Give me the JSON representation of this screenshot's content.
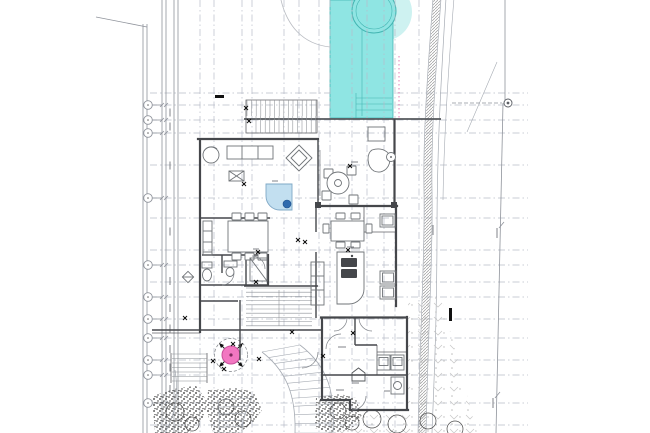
{
  "meta": {
    "canvas_width": 650,
    "canvas_height": 433,
    "drawing_kind": "architectural site and floor plan, no legible text labels"
  },
  "colors": {
    "background": "#ffffff",
    "grid_line": "#b7bcc8",
    "boundary_line": "#8f939b",
    "wall": "#45474b",
    "furniture_line": "#6f7377",
    "pool_fill": "#8fe5e3",
    "pool_edge": "#43b5b2",
    "pool_halo": "#cef2f1",
    "water_feature_fill": "#c2dff0",
    "water_feature_dot": "#2f6bae",
    "tree_pink": "#f277c1",
    "tree_pink_dark": "#c94f9b",
    "setback_pink": "#e06fae",
    "stipple": "#2e2e2e",
    "hatch": "#9a9a9a",
    "paver": "#c2c2c2",
    "marker_black": "#111111",
    "micro_text": "#777b80"
  },
  "drawing": {
    "grid": {
      "vertical_x": [
        200,
        214,
        242,
        252,
        284,
        299,
        319,
        330,
        352,
        367,
        384,
        395,
        419
      ],
      "horizontal_y": [
        93,
        105,
        120,
        133,
        165,
        198,
        218,
        250,
        265,
        282,
        297,
        319,
        338,
        360,
        375,
        403,
        425
      ],
      "h_x1": 150,
      "h_x2": 528
    },
    "boundary": {
      "lines": [
        {
          "x": 143,
          "y1": 24,
          "y2": 433
        },
        {
          "x": 147,
          "y1": 24,
          "y2": 433
        },
        {
          "x": 162,
          "y1": 0,
          "y2": 433
        },
        {
          "x": 166,
          "y1": 0,
          "y2": 433
        },
        {
          "x": 174,
          "y1": 0,
          "y2": 433
        },
        {
          "x": 178,
          "y1": 0,
          "y2": 433
        }
      ],
      "diagonal": {
        "x1": 96,
        "y1": 17,
        "x2": 147,
        "y2": 27
      },
      "bubbles_x": 148,
      "bubbles_y": [
        105,
        120,
        133,
        198,
        265,
        297,
        319,
        338,
        360,
        375,
        403
      ],
      "dim_text_x": 170
    },
    "pool": {
      "x": 330,
      "y": 0,
      "w": 63,
      "h": 118,
      "lane_x": 362,
      "steps_y": [
        98,
        104,
        110
      ],
      "steps_x1": 356,
      "steps_x2": 392,
      "spa": {
        "cx": 374,
        "cy": 11,
        "r_outer": 22,
        "r_inner": 18
      },
      "halo": {
        "cx": 383,
        "cy": 12,
        "r": 29
      },
      "setback": {
        "x": 399,
        "y1": 56,
        "y2": 118
      }
    },
    "stairs": [
      {
        "x": 247,
        "y": 100,
        "w": 70,
        "h": 16,
        "dir": "v",
        "step": 4.6
      },
      {
        "x": 256,
        "y": 116,
        "w": 61,
        "h": 17,
        "dir": "v",
        "step": 4.6
      },
      {
        "x": 246,
        "y": 288,
        "w": 66,
        "h": 40,
        "dir": "h",
        "step": 4.2
      },
      {
        "x": 172,
        "y": 354,
        "w": 35,
        "h": 28,
        "dir": "h",
        "step": 4.5
      }
    ],
    "walk_fans": [
      {
        "outer": [
          300,
          345,
          330,
          368,
          335,
          395,
          333,
          433
        ],
        "inner": [
          262,
          352,
          288,
          372,
          296,
          398,
          295,
          433
        ],
        "rungs": 12
      },
      {
        "outer": [
          252,
          398,
          245,
          412,
          242,
          422,
          242,
          433
        ],
        "inner": [
          218,
          400,
          220,
          412,
          219,
          424,
          219,
          433
        ],
        "rungs": 6
      }
    ],
    "furniture_sets": {
      "dining_chairs": [
        [
          232,
          213
        ],
        [
          245,
          213
        ],
        [
          258,
          213
        ],
        [
          232,
          253
        ],
        [
          245,
          253
        ],
        [
          258,
          253
        ]
      ],
      "breakfast_chairs": [
        [
          336,
          213
        ],
        [
          351,
          213
        ],
        [
          336,
          242
        ],
        [
          351,
          242
        ]
      ],
      "breakfast_side_chairs": [
        [
          323,
          224
        ],
        [
          366,
          224
        ]
      ],
      "terrace_chairs": [
        [
          324,
          169
        ],
        [
          347,
          166
        ],
        [
          322,
          191
        ],
        [
          349,
          195
        ]
      ]
    },
    "tree": {
      "cx": 231,
      "cy": 355,
      "r_ring": 16.5,
      "r": 9
    },
    "spot_marks": [
      [
        246,
        108
      ],
      [
        249,
        121
      ],
      [
        244,
        184
      ],
      [
        298,
        240
      ],
      [
        350,
        166
      ],
      [
        258,
        252
      ],
      [
        256,
        282
      ],
      [
        259,
        359
      ],
      [
        292,
        332
      ],
      [
        233,
        344
      ],
      [
        224,
        369
      ],
      [
        213,
        361
      ],
      [
        323,
        356
      ],
      [
        353,
        333
      ],
      [
        305,
        242
      ],
      [
        348,
        250
      ],
      [
        185,
        318
      ]
    ],
    "black_dashes": [
      [
        215,
        95,
        9,
        3
      ],
      [
        449,
        308,
        3,
        13
      ]
    ],
    "micro_labels": [
      {
        "x": 272,
        "y": 181,
        "len": 6,
        "v": false
      },
      {
        "x": 338,
        "y": 347,
        "len": 8,
        "v": false
      },
      {
        "x": 336,
        "y": 390,
        "len": 8,
        "v": false
      },
      {
        "x": 352,
        "y": 383,
        "len": 7,
        "v": false
      },
      {
        "x": 384,
        "y": 391,
        "len": 6,
        "v": false
      },
      {
        "x": 253,
        "y": 249,
        "len": 6,
        "v": false
      },
      {
        "x": 347,
        "y": 247,
        "len": 7,
        "v": false
      },
      {
        "x": 351,
        "y": 162,
        "len": 7,
        "v": false
      },
      {
        "x": 497,
        "y": 228,
        "len": 10,
        "v": true
      },
      {
        "x": 493,
        "y": 398,
        "len": 10,
        "v": true
      },
      {
        "x": 433,
        "y": 225,
        "len": 10,
        "v": true
      }
    ],
    "scallop_trees_open": [
      [
        175,
        412,
        9
      ],
      [
        192,
        424,
        7
      ],
      [
        226,
        407,
        8
      ],
      [
        243,
        419,
        8
      ],
      [
        338,
        411,
        8
      ],
      [
        352,
        423,
        7
      ]
    ],
    "scallop_trees_filled": [
      [
        372,
        419,
        9
      ],
      [
        397,
        424,
        9
      ],
      [
        428,
        421,
        8
      ],
      [
        455,
        429,
        8
      ]
    ]
  }
}
